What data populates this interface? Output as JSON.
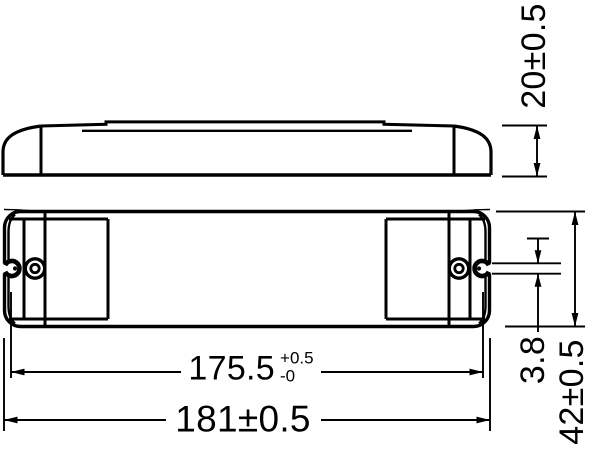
{
  "colors": {
    "background": "#ffffff",
    "line": "#000000"
  },
  "dimensions": {
    "height": {
      "label": "20±0.5"
    },
    "terminal_pitch": {
      "value": "175.5",
      "tol_plus": "+0.5",
      "tol_minus": "-0"
    },
    "length": {
      "label": "181±0.5"
    },
    "hole_diameter": {
      "label": "3.8"
    },
    "width": {
      "label": "42±0.5"
    }
  }
}
